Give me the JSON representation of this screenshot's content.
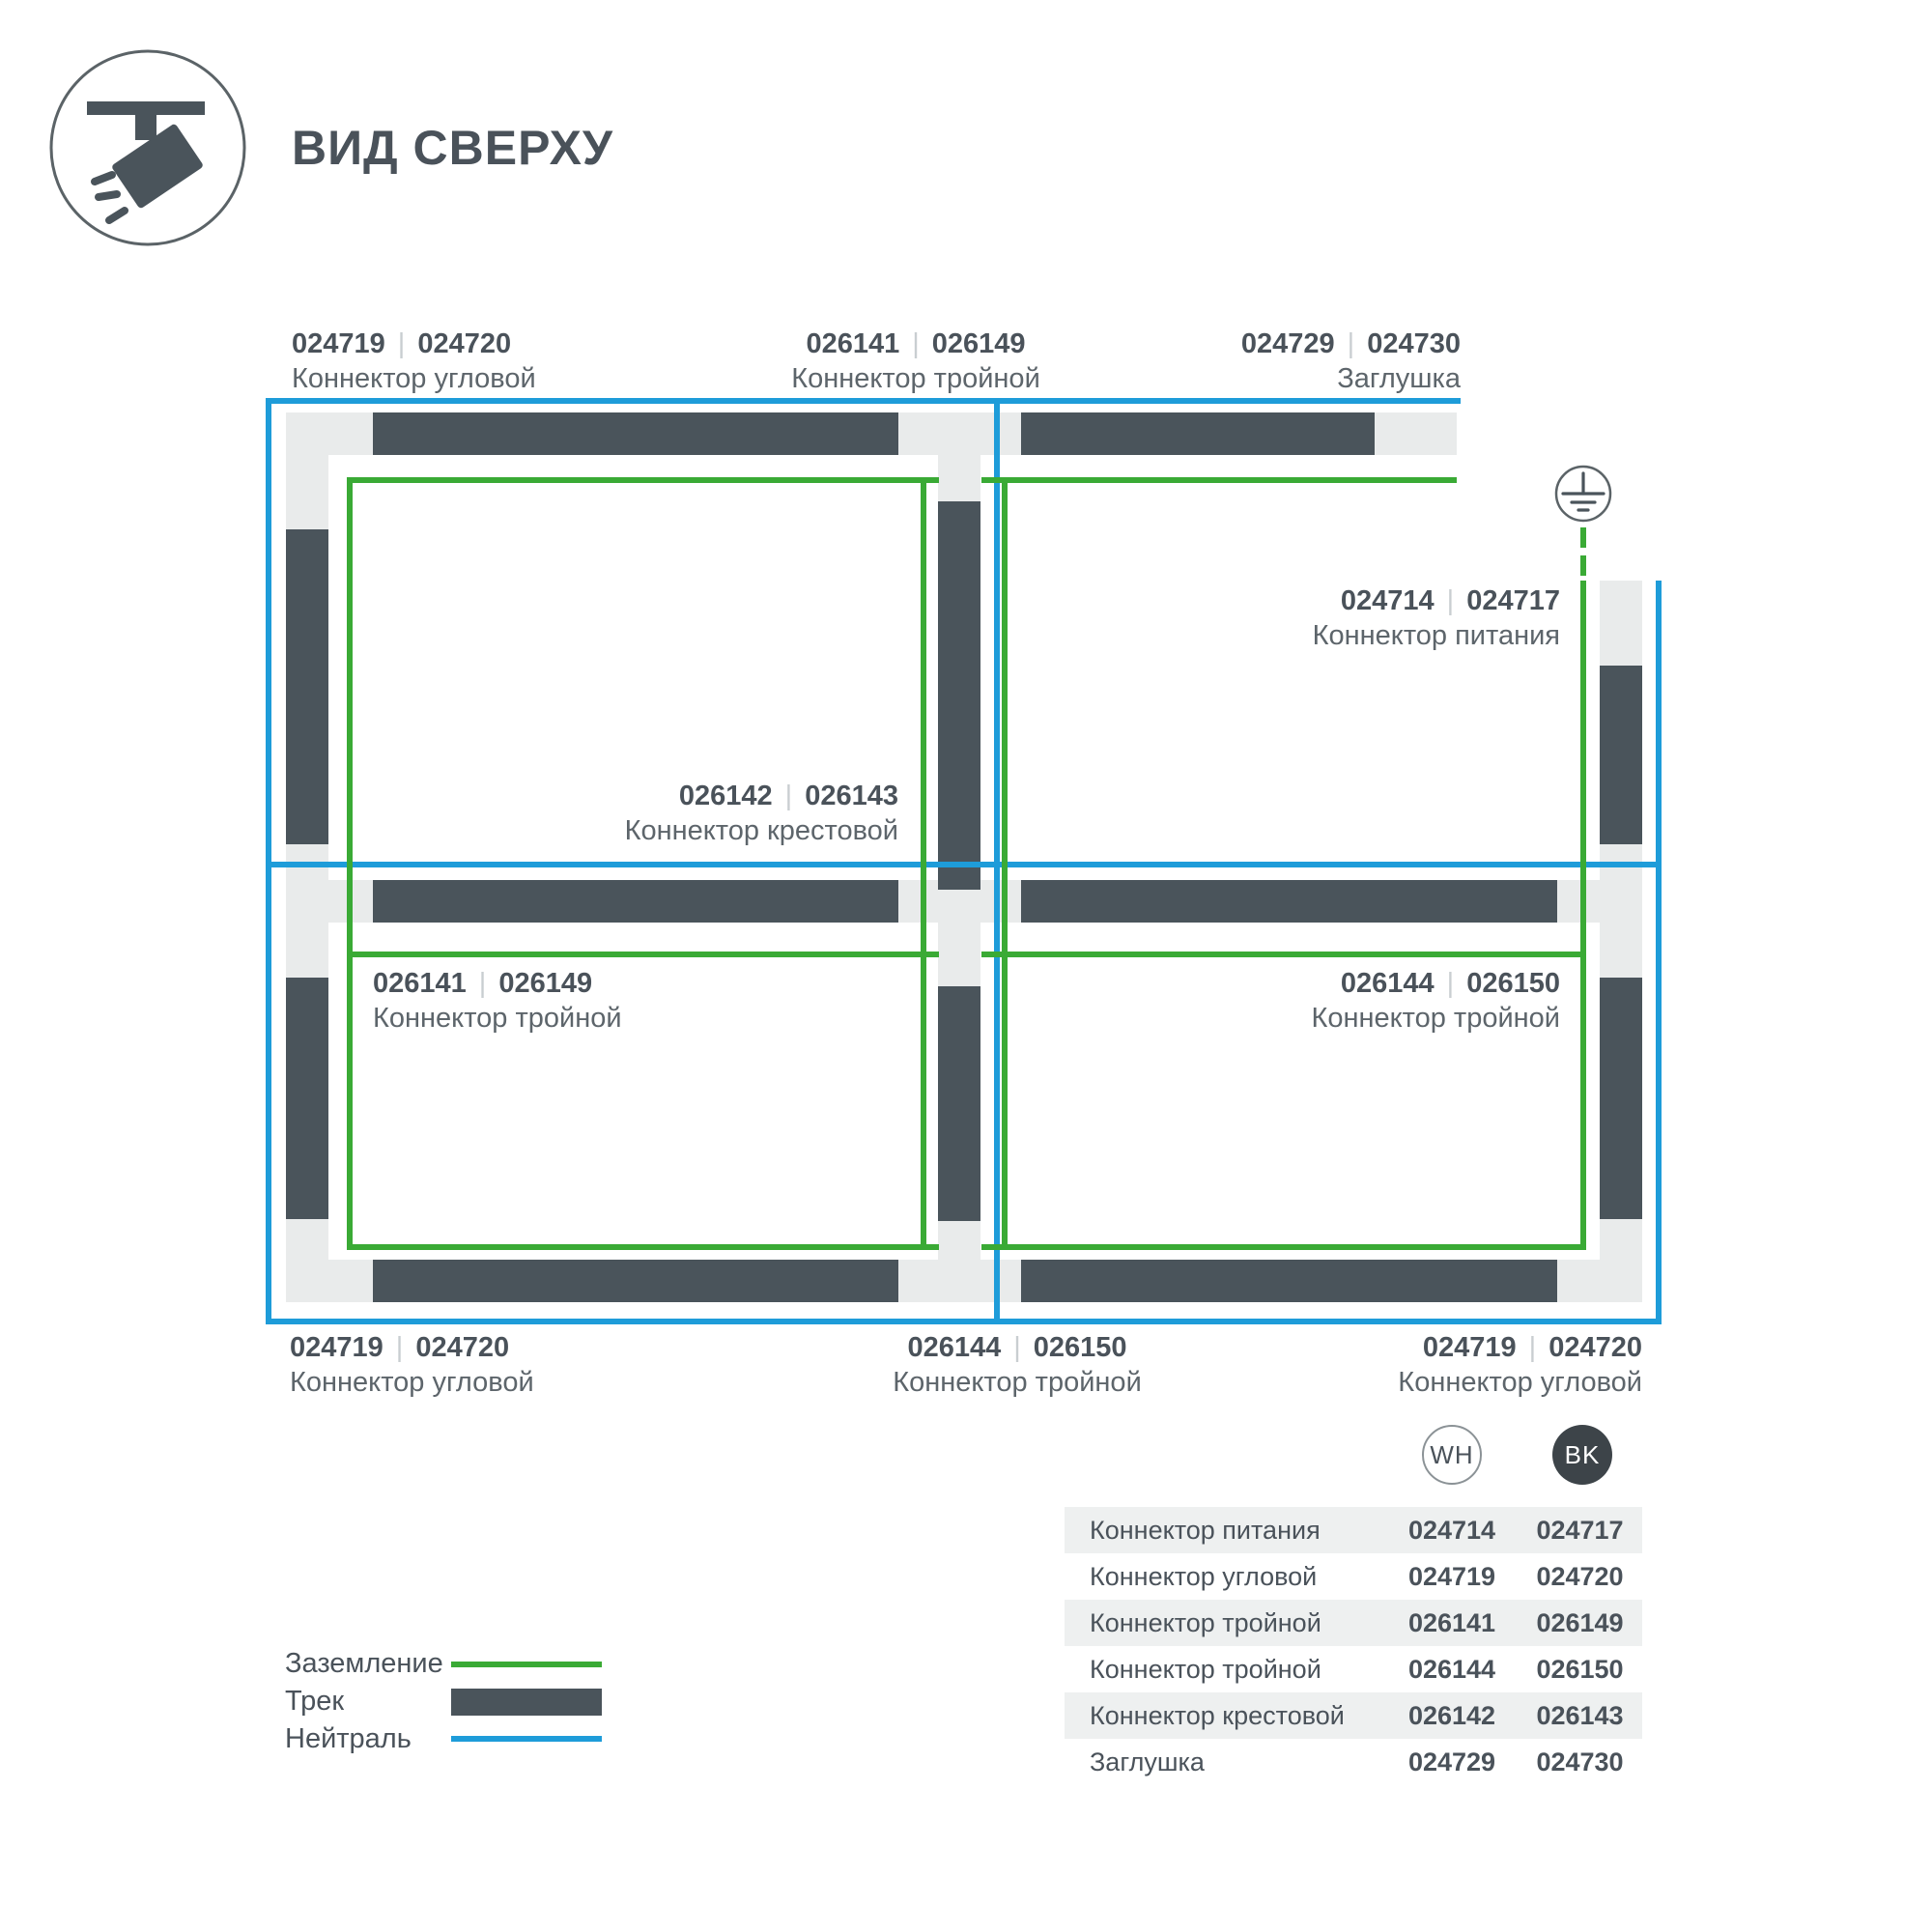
{
  "header": {
    "title": "ВИД СВЕРХУ"
  },
  "ui": {
    "separator": "|"
  },
  "colors": {
    "track_dark": "#4a545b",
    "track_base": "#e9ebeb",
    "ground_green": "#3aaa35",
    "neutral_blue": "#1e9cd9"
  },
  "diagram": {
    "labels": {
      "corner_top_left": {
        "codes": [
          "024719",
          "024720"
        ],
        "name": "Коннектор угловой"
      },
      "tee_top_center": {
        "codes": [
          "026141",
          "026149"
        ],
        "name": "Коннектор тройной"
      },
      "endcap_top_right": {
        "codes": [
          "024729",
          "024730"
        ],
        "name": "Заглушка"
      },
      "power": {
        "codes": [
          "024714",
          "024717"
        ],
        "name": "Коннектор питания"
      },
      "cross_center": {
        "codes": [
          "026142",
          "026143"
        ],
        "name": "Коннектор крестовой"
      },
      "tee_mid_left": {
        "codes": [
          "026141",
          "026149"
        ],
        "name": "Коннектор тройной"
      },
      "tee_mid_right": {
        "codes": [
          "026144",
          "026150"
        ],
        "name": "Коннектор тройной"
      },
      "corner_bottom_left": {
        "codes": [
          "024719",
          "024720"
        ],
        "name": "Коннектор угловой"
      },
      "tee_bottom_center": {
        "codes": [
          "026144",
          "026150"
        ],
        "name": "Коннектор тройной"
      },
      "corner_bottom_right": {
        "codes": [
          "024719",
          "024720"
        ],
        "name": "Коннектор угловой"
      }
    }
  },
  "legend": {
    "ground": "Заземление",
    "track": "Трек",
    "neutral": "Нейтраль"
  },
  "table": {
    "col_wh": "WH",
    "col_bk": "BK",
    "rows": [
      {
        "name": "Коннектор питания",
        "wh": "024714",
        "bk": "024717"
      },
      {
        "name": "Коннектор угловой",
        "wh": "024719",
        "bk": "024720"
      },
      {
        "name": "Коннектор тройной",
        "wh": "026141",
        "bk": "026149"
      },
      {
        "name": "Коннектор тройной",
        "wh": "026144",
        "bk": "026150"
      },
      {
        "name": "Коннектор крестовой",
        "wh": "026142",
        "bk": "026143"
      },
      {
        "name": "Заглушка",
        "wh": "024729",
        "bk": "024730"
      }
    ]
  }
}
